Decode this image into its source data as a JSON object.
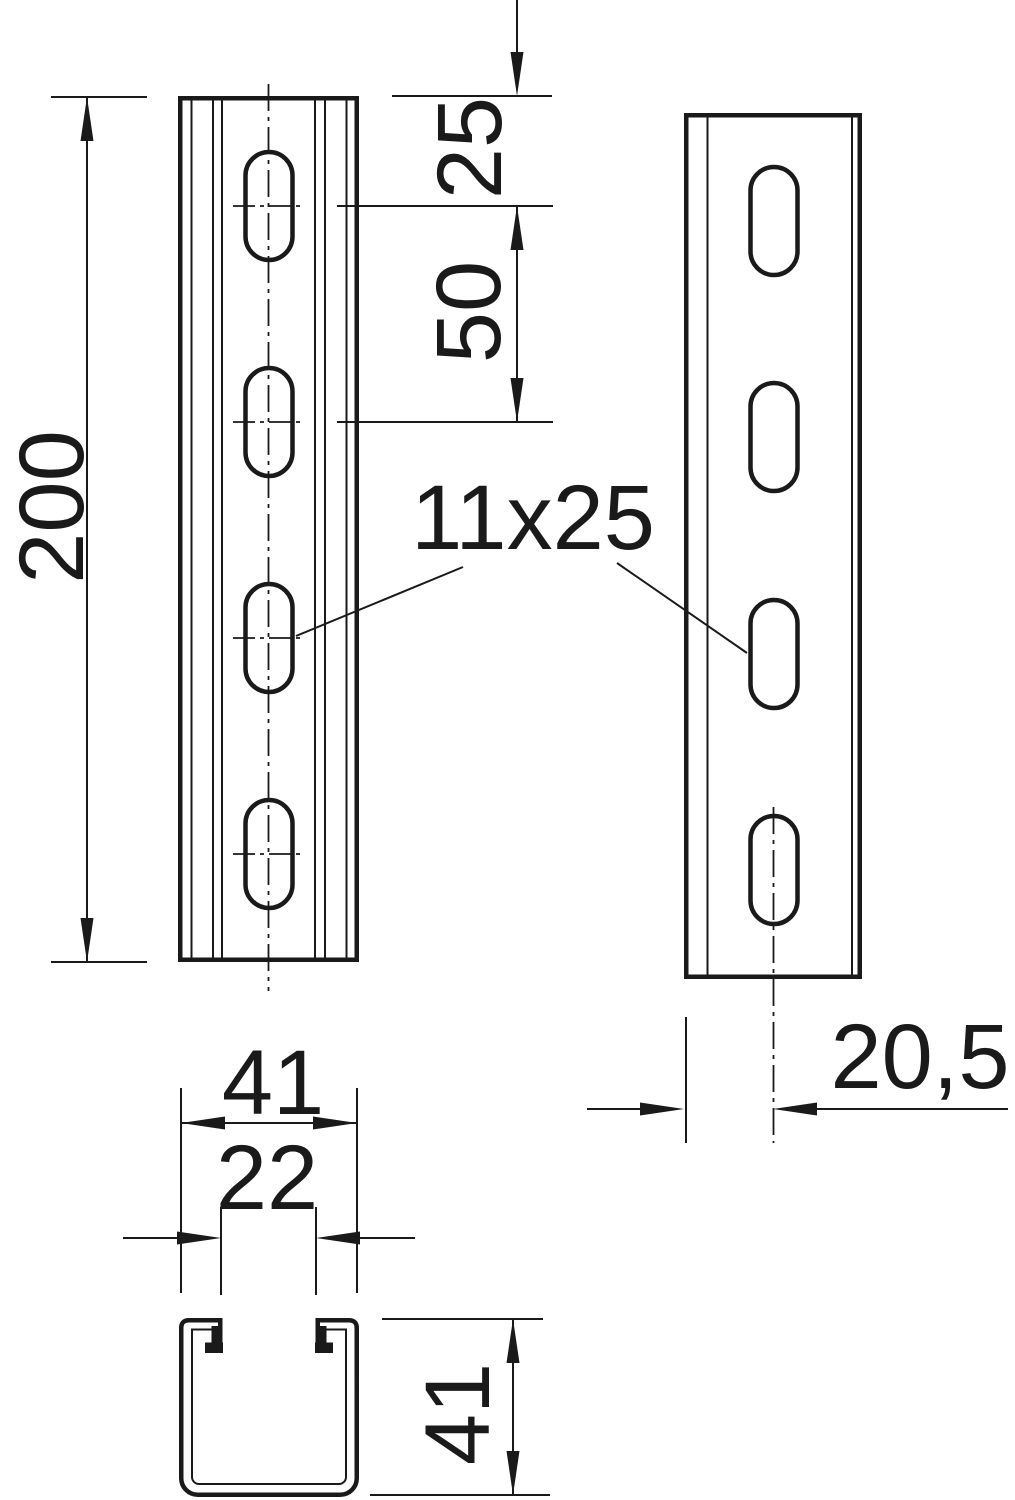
{
  "drawing": {
    "colors": {
      "ink": "#1a1a1a",
      "background": "#ffffff"
    },
    "dimensions": {
      "front_length": "200",
      "first_slot_offset": "25",
      "slot_pitch": "50",
      "slot_size_label": "11x25",
      "section_width": "41",
      "section_opening": "22",
      "section_height": "41",
      "side_slot_offset": "20,5"
    }
  }
}
